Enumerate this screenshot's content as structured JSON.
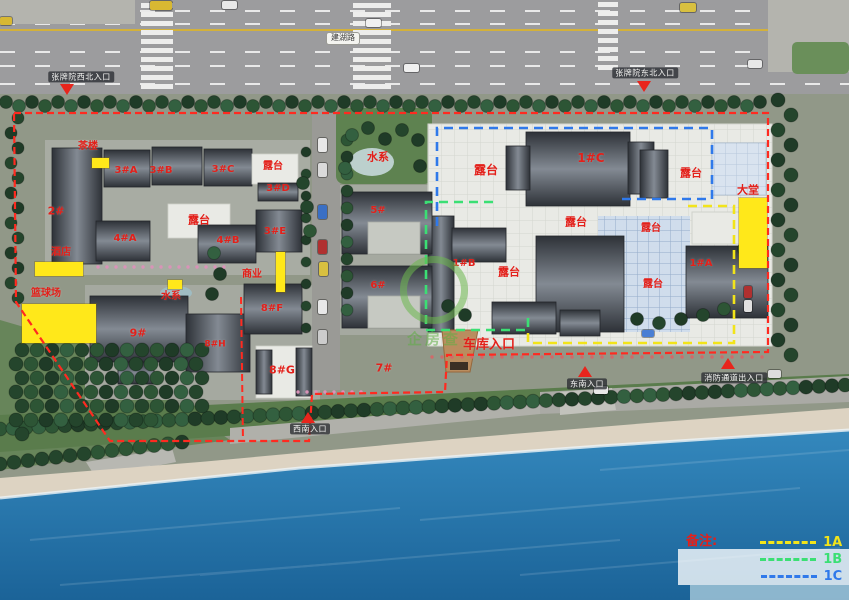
{
  "road": {
    "name_label": "建湖路"
  },
  "zones": {
    "boundary_color": "#ff2a20",
    "a": "#f2e41a",
    "b": "#3bdf74",
    "c": "#2f79ea"
  },
  "legend": {
    "title": "备注:",
    "items": [
      {
        "label": "1A",
        "color": "#f2e41a"
      },
      {
        "label": "1B",
        "color": "#3bdf74"
      },
      {
        "label": "1C",
        "color": "#2f79ea"
      }
    ]
  },
  "watermark": {
    "text": "企房查"
  },
  "map_labels": [
    {
      "text": "茶楼",
      "x": 88,
      "y": 147,
      "fs": 10
    },
    {
      "text": "3#A",
      "x": 126,
      "y": 171,
      "fs": 10
    },
    {
      "text": "3#B",
      "x": 161,
      "y": 171,
      "fs": 10
    },
    {
      "text": "3#C",
      "x": 223,
      "y": 170,
      "fs": 10
    },
    {
      "text": "露台",
      "x": 273,
      "y": 167,
      "fs": 10
    },
    {
      "text": "3#D",
      "x": 278,
      "y": 189,
      "fs": 10
    },
    {
      "text": "2#",
      "x": 56,
      "y": 211,
      "fs": 11
    },
    {
      "text": "露台",
      "x": 199,
      "y": 220,
      "fs": 11
    },
    {
      "text": "4#A",
      "x": 125,
      "y": 239,
      "fs": 10
    },
    {
      "text": "4#B",
      "x": 228,
      "y": 241,
      "fs": 10
    },
    {
      "text": "3#E",
      "x": 275,
      "y": 232,
      "fs": 10
    },
    {
      "text": "酒店",
      "x": 61,
      "y": 253,
      "fs": 10
    },
    {
      "text": "商业",
      "x": 252,
      "y": 275,
      "fs": 10
    },
    {
      "text": "篮球场",
      "x": 46,
      "y": 294,
      "fs": 10
    },
    {
      "text": "水系",
      "x": 171,
      "y": 297,
      "fs": 10
    },
    {
      "text": "8#F",
      "x": 272,
      "y": 309,
      "fs": 10
    },
    {
      "text": "9#",
      "x": 138,
      "y": 333,
      "fs": 11
    },
    {
      "text": "8#H",
      "x": 215,
      "y": 345,
      "fs": 9
    },
    {
      "text": "8#G",
      "x": 282,
      "y": 370,
      "fs": 11
    },
    {
      "text": "7#",
      "x": 384,
      "y": 368,
      "fs": 11
    },
    {
      "text": "5#",
      "x": 378,
      "y": 211,
      "fs": 10
    },
    {
      "text": "6#",
      "x": 378,
      "y": 286,
      "fs": 10
    },
    {
      "text": "水系",
      "x": 378,
      "y": 157,
      "fs": 11
    },
    {
      "text": "露台",
      "x": 486,
      "y": 170,
      "fs": 12
    },
    {
      "text": "1#C",
      "x": 591,
      "y": 158,
      "fs": 12
    },
    {
      "text": "露台",
      "x": 691,
      "y": 173,
      "fs": 11
    },
    {
      "text": "大堂",
      "x": 748,
      "y": 190,
      "fs": 11
    },
    {
      "text": "露台",
      "x": 576,
      "y": 222,
      "fs": 11
    },
    {
      "text": "露台",
      "x": 651,
      "y": 229,
      "fs": 10
    },
    {
      "text": "1#B",
      "x": 464,
      "y": 264,
      "fs": 10
    },
    {
      "text": "露台",
      "x": 509,
      "y": 272,
      "fs": 11
    },
    {
      "text": "露台",
      "x": 653,
      "y": 285,
      "fs": 10
    },
    {
      "text": "1#A",
      "x": 701,
      "y": 264,
      "fs": 10
    },
    {
      "text": "车库入口",
      "x": 489,
      "y": 345,
      "fs": 13
    }
  ],
  "entrance_labels": [
    {
      "id": "northwest",
      "text": "张牌院西北入口",
      "x": 81,
      "y": 77
    },
    {
      "id": "northeast",
      "text": "张牌院东北入口",
      "x": 645,
      "y": 73
    },
    {
      "id": "southeast",
      "text": "东南入口",
      "x": 587,
      "y": 384
    },
    {
      "id": "fire-lane",
      "text": "消防通道出入口",
      "x": 734,
      "y": 378
    },
    {
      "id": "southwest",
      "text": "西南入口",
      "x": 310,
      "y": 429
    }
  ],
  "entrance_markers": [
    {
      "dir": "down",
      "x": 67,
      "y": 84
    },
    {
      "dir": "down",
      "x": 644,
      "y": 81
    },
    {
      "dir": "up",
      "x": 585,
      "y": 366
    },
    {
      "dir": "up",
      "x": 728,
      "y": 358
    },
    {
      "dir": "up",
      "x": 308,
      "y": 412
    }
  ],
  "highlight_boxes": [
    {
      "x": 92,
      "y": 158,
      "w": 17,
      "h": 10
    },
    {
      "x": 35,
      "y": 262,
      "w": 48,
      "h": 14
    },
    {
      "x": 22,
      "y": 304,
      "w": 74,
      "h": 39
    },
    {
      "x": 168,
      "y": 280,
      "w": 14,
      "h": 9
    },
    {
      "x": 276,
      "y": 252,
      "w": 9,
      "h": 40
    },
    {
      "x": 739,
      "y": 198,
      "w": 28,
      "h": 70
    }
  ],
  "vehicles": [
    {
      "x": 150,
      "y": 1,
      "w": 22,
      "h": 9,
      "color": "#d8b832"
    },
    {
      "x": 222,
      "y": 1,
      "w": 15,
      "h": 8,
      "color": "#e8e8e8"
    },
    {
      "x": 366,
      "y": 19,
      "w": 15,
      "h": 8,
      "color": "#f0f0f0"
    },
    {
      "x": 404,
      "y": 64,
      "w": 15,
      "h": 8,
      "color": "#f0f0f0"
    },
    {
      "x": 680,
      "y": 3,
      "w": 16,
      "h": 9,
      "color": "#d8c040"
    },
    {
      "x": 0,
      "y": 17,
      "w": 12,
      "h": 8,
      "color": "#d8b832"
    },
    {
      "x": 748,
      "y": 60,
      "w": 14,
      "h": 8,
      "color": "#e8e8e8"
    },
    {
      "x": 318,
      "y": 138,
      "w": 9,
      "h": 14,
      "color": "#e8e8e8"
    },
    {
      "x": 318,
      "y": 163,
      "w": 9,
      "h": 14,
      "color": "#dadada"
    },
    {
      "x": 318,
      "y": 205,
      "w": 9,
      "h": 14,
      "color": "#3a6fc4"
    },
    {
      "x": 318,
      "y": 240,
      "w": 9,
      "h": 14,
      "color": "#b03030"
    },
    {
      "x": 319,
      "y": 262,
      "w": 9,
      "h": 14,
      "color": "#d8c040"
    },
    {
      "x": 318,
      "y": 300,
      "w": 9,
      "h": 14,
      "color": "#e8e8e8"
    },
    {
      "x": 318,
      "y": 330,
      "w": 9,
      "h": 14,
      "color": "#cccccc"
    },
    {
      "x": 594,
      "y": 386,
      "w": 14,
      "h": 8,
      "color": "#e8e8e8"
    },
    {
      "x": 768,
      "y": 370,
      "w": 13,
      "h": 8,
      "color": "#dddddd"
    },
    {
      "x": 642,
      "y": 330,
      "w": 12,
      "h": 7,
      "color": "#4a7fd4"
    },
    {
      "x": 744,
      "y": 286,
      "w": 8,
      "h": 12,
      "color": "#b03030"
    },
    {
      "x": 744,
      "y": 300,
      "w": 8,
      "h": 12,
      "color": "#e0e0e0"
    }
  ]
}
